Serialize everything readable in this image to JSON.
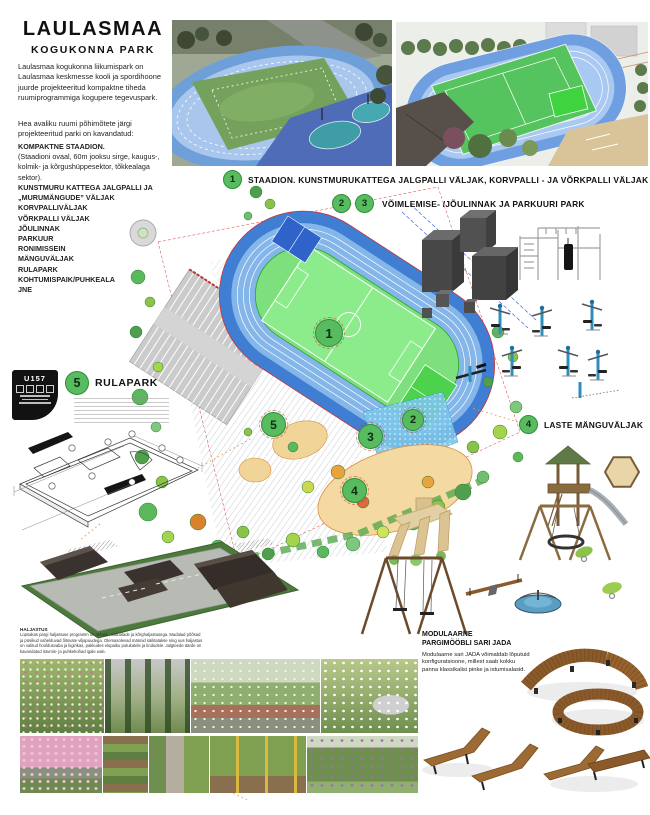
{
  "poster": {
    "title": "LAULASMAA",
    "subtitle": "KOGUKONNA PARK",
    "intro1": "Laulasmaa kogukonna liikumispark on Laulasmaa keskmesse kooli ja spordihoone juurde projekteeritud kompaktne tiheda ruumiprogrammiga kogupere tegevuspark.",
    "intro2": "Hea avaliku ruumi põhimõtete järgi projekteeritud parki on kavandatud:",
    "features": [
      "KOMPAKTNE STAADION.",
      "(Staadioni ovaal, 60m jooksu sirge, kaugus-, kolmik- ja kõrgushüppesektor, tõkkealaga sektor).",
      "KUNSTMURU KATTEGA JALGPALLI JA „MURUMÄNGUDE” VÄLJAK",
      "KORVPALLIVÄLJAK",
      "VÕRKPALLI VÄLJAK",
      "JÕULINNAK",
      "PARKUUR",
      "RONIMISSEIN",
      "MÄNGUVÄLJAK",
      "RULAPARK",
      "KOHTUMISPAIK/PUHKEALA",
      "JNE"
    ]
  },
  "sections": {
    "s1": {
      "num": "1",
      "label": "STAADION. KUNSTMURUKATTEGA JALGPALLI VÄLJAK, KORVPALLI - JA VÕRKPALLI VÄLJAK"
    },
    "s23": {
      "num_a": "2",
      "num_b": "3",
      "label": "VÕIMLEMISE- /JÕULINNAK JA PARKUURI PARK"
    },
    "s4": {
      "num": "4",
      "label": "LASTE MÄNGUVÄLJAK"
    },
    "s5": {
      "num": "5",
      "label": "RULAPARK"
    }
  },
  "plan": {
    "m1": "1",
    "m2": "2",
    "m3": "3",
    "m4": "4",
    "m5": "5"
  },
  "badge": {
    "code": "U157"
  },
  "notes": {
    "greenery_heading": "HALJASTUS",
    "greenery_body": "Lopsakas pargi haljastuse programm on rikkalik, niidualade ja kõrghaljastusega. Madalad põõsad ja püsikud vahelduvad õitsvate viljapuudega. Olemasolevad männid säilitatakse ning uus haljastus on valitud hooldusvaba ja liigirikas, pakkudes elupaiku putukatele ja lindudele. Jalgteede äärde on kavandatud istumis- ja puhkekohad igale eale."
  },
  "furniture": {
    "heading1": "MODULAARNE",
    "heading2": "PARGIMÖÖBLI SARI JADA",
    "body": "Modulaarne sari JADA võimaldab lõputuid konfiguratsioone, millest saab kokku panna klassikalisi pinke ja istumisalasid."
  },
  "colors": {
    "marker_green": "#58bb5f",
    "track_blue": "#3f7ed2",
    "field_green": "#7de07d",
    "sand_beige": "#f5d9a2",
    "bench_brown": "#8a5a2b"
  }
}
